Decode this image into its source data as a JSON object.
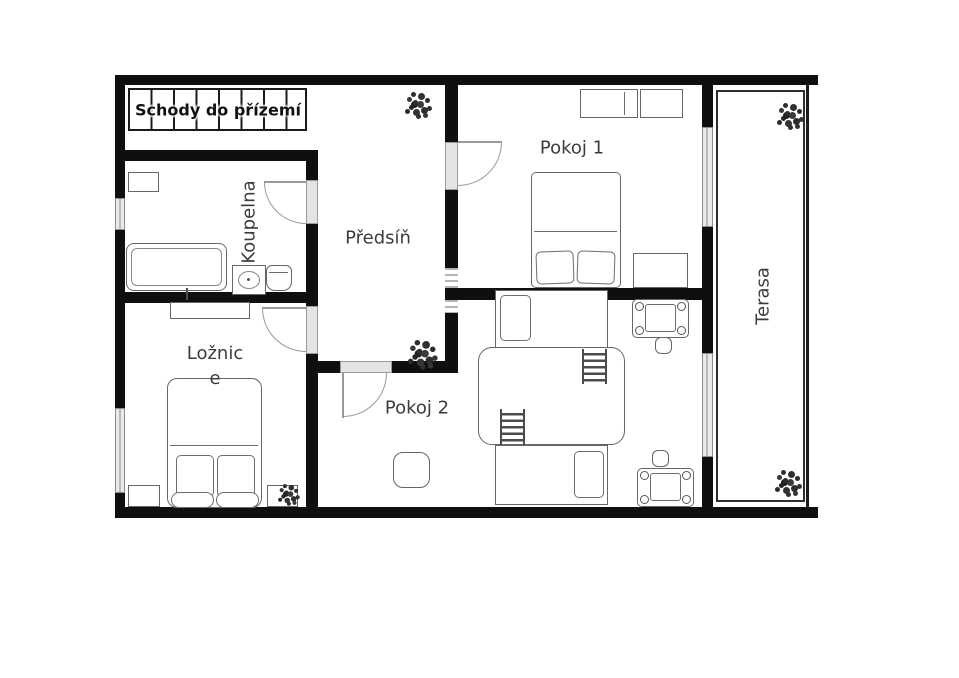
{
  "colors": {
    "wall": "#0f0f0f",
    "furniture_stroke": "#666666",
    "door_arc": "#9a9a9a",
    "window_fill": "#e9e9e9",
    "label_text": "#3c3c3c"
  },
  "rooms": {
    "stairs": {
      "label": "Schody do přízemí"
    },
    "koupelna": {
      "label": "Koupelna"
    },
    "predsin": {
      "label": "Předsíň"
    },
    "pokoj1": {
      "label": "Pokoj 1"
    },
    "loznice": {
      "label": "Ložnice"
    },
    "pokoj2": {
      "label": "Pokoj 2"
    },
    "terasa": {
      "label": "Terasa"
    }
  }
}
